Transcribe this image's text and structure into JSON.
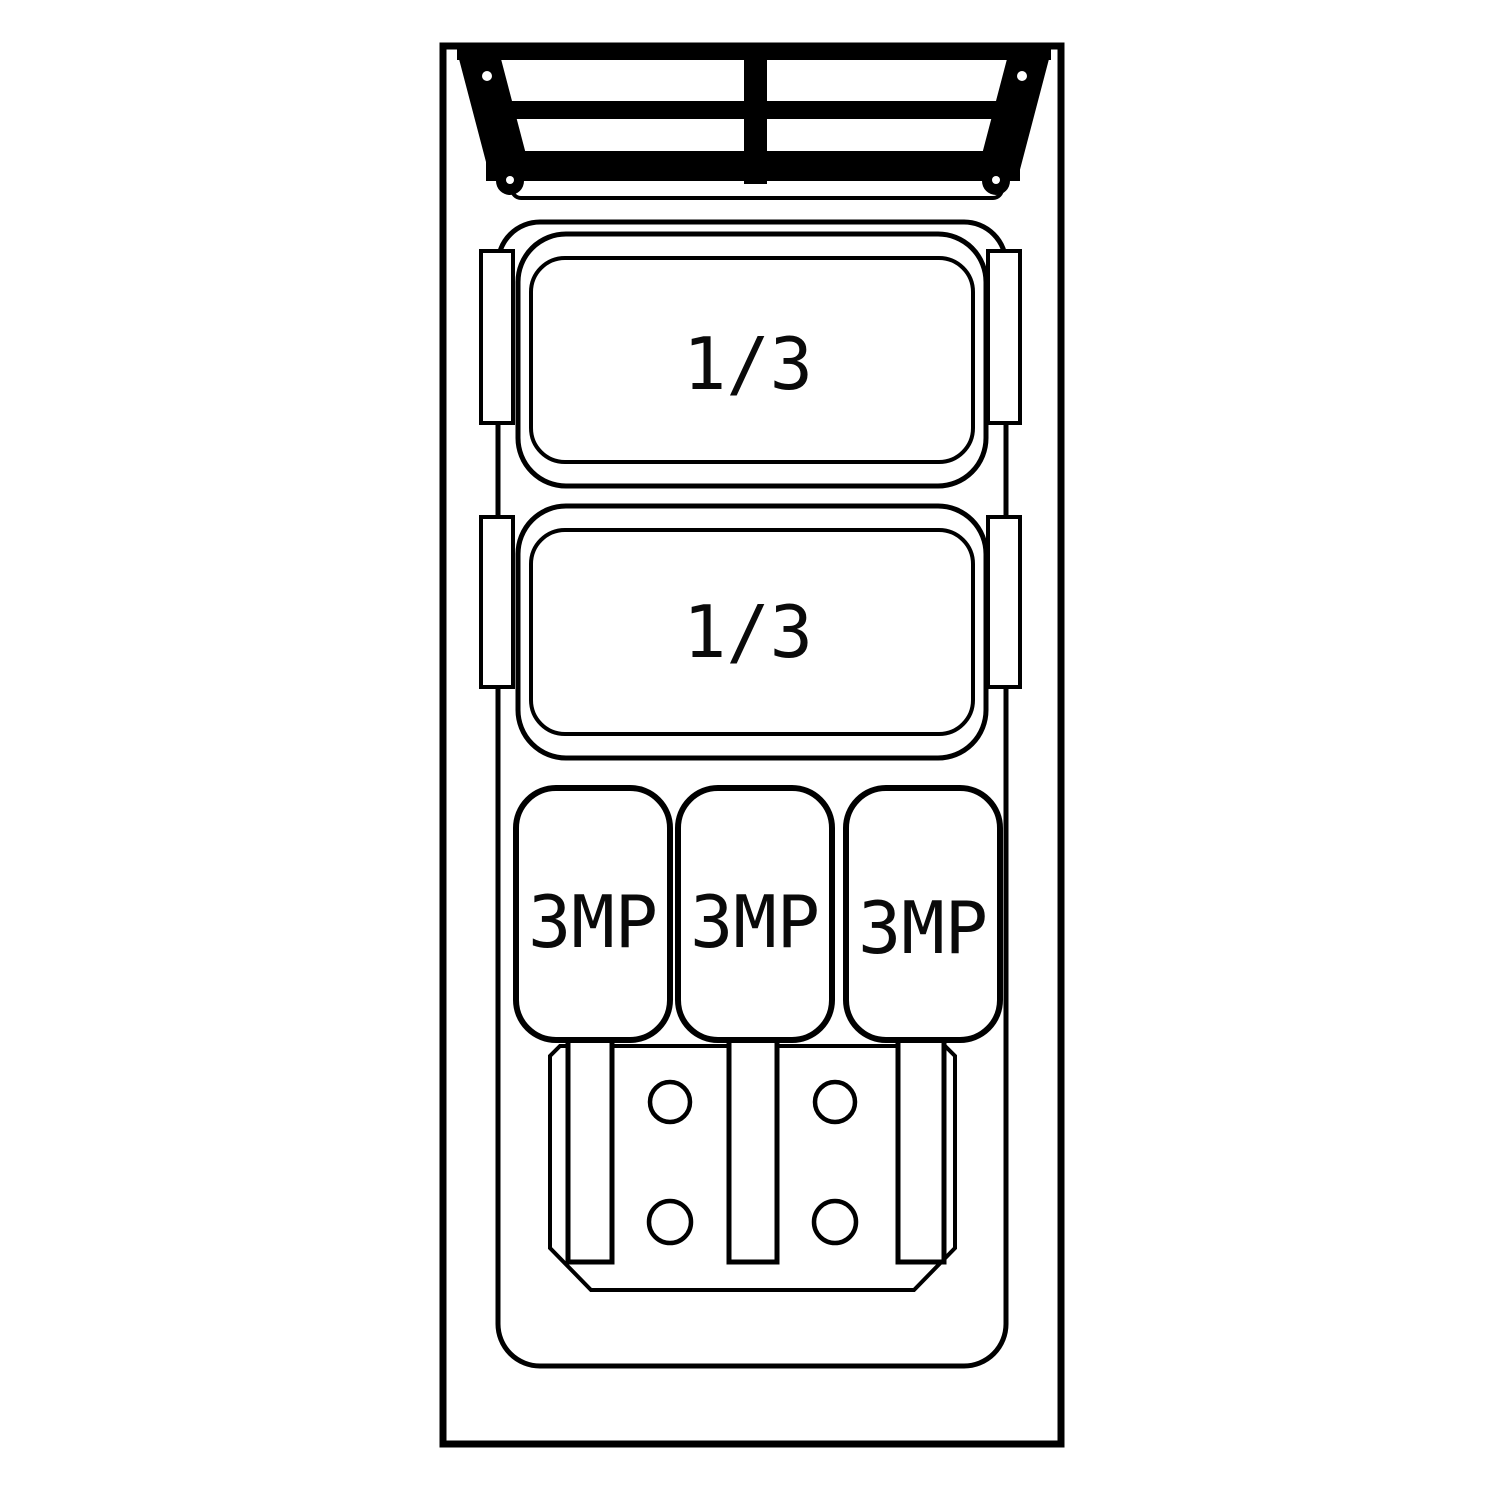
{
  "page": {
    "background_color": "#ffffff"
  },
  "drawing": {
    "kind": "equipment-top-view-line-drawing",
    "line_color": "#000000",
    "fill_color": "#ffffff",
    "text_color": "#0a0a0a",
    "grille": {
      "name": "ventilation-grille",
      "columns": 2,
      "slat_rows": 2
    },
    "large_pans": [
      {
        "label": "1/3"
      },
      {
        "label": "1/3"
      }
    ],
    "small_pans": [
      {
        "label": "3MP"
      },
      {
        "label": "3MP"
      },
      {
        "label": "3MP"
      }
    ],
    "plate": {
      "stem_count": 3,
      "hole_count": 4
    }
  }
}
